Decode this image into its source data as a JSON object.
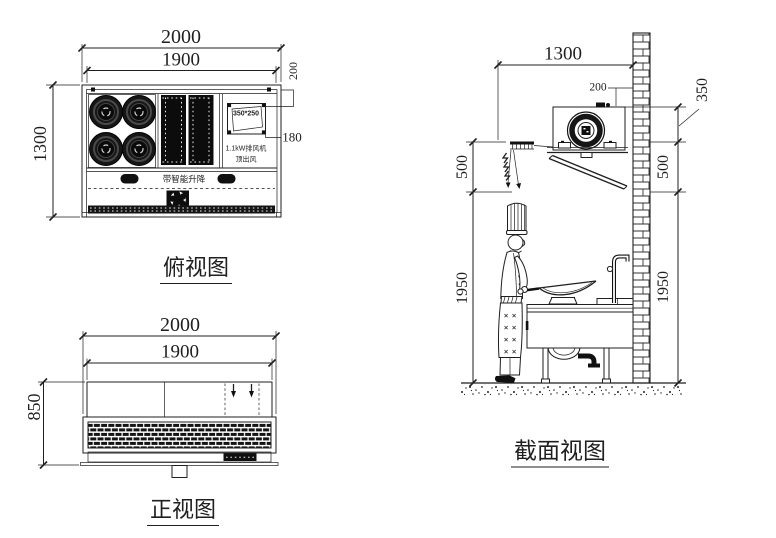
{
  "top_view": {
    "title": "俯视图",
    "dim_width_outer": "2000",
    "dim_width_inner": "1900",
    "dim_depth": "1300",
    "dim_offset_duct": "200",
    "dim_offset_box": "180",
    "outlet_size": "350*250",
    "fan_spec": "1.1kW排风机",
    "air_outlet": "顶出风",
    "lift_feature": "带智能升降"
  },
  "front_view": {
    "title": "正视图",
    "dim_width_outer": "2000",
    "dim_width_inner": "1900",
    "dim_height": "850"
  },
  "section_view": {
    "title": "截面视图",
    "dim_hood_width": "1300",
    "dim_duct_to_wall": "200",
    "dim_above_hood": "350",
    "dim_hood_height_left": "500",
    "dim_hood_height_right": "500",
    "dim_hood_to_floor_left": "1950",
    "dim_hood_to_floor_right": "1950"
  },
  "colors": {
    "line": "#1f1f1f",
    "fill_dark": "#101010",
    "background": "#ffffff"
  }
}
